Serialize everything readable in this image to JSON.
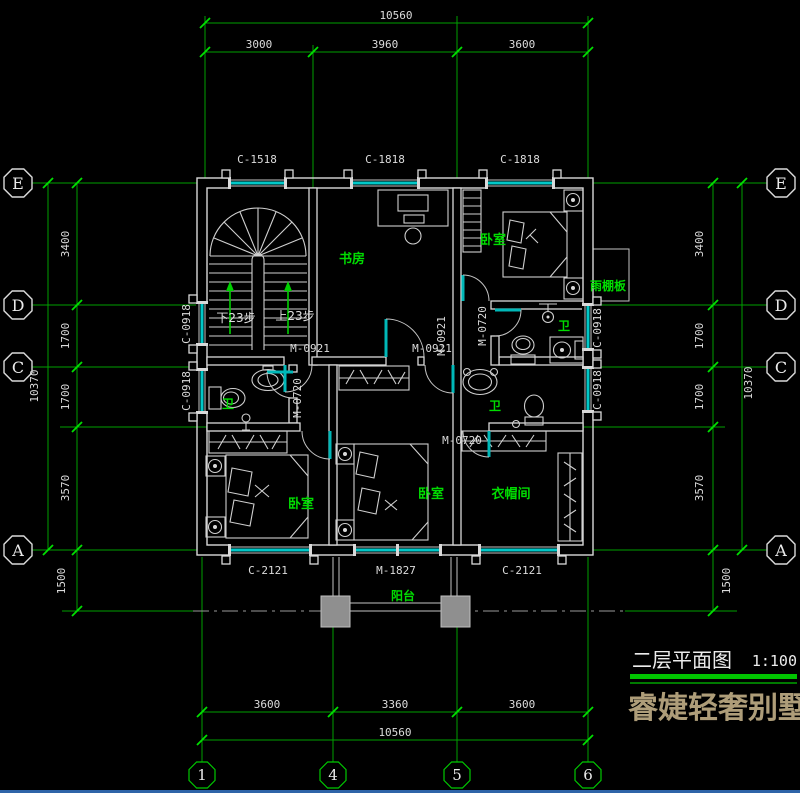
{
  "drawing": {
    "title": "二层平面图",
    "scale": "1:100",
    "brand": "睿婕轻奢别墅"
  },
  "grid": {
    "rows": [
      "E",
      "D",
      "C",
      "A"
    ],
    "cols": [
      "1",
      "4",
      "5",
      "6"
    ]
  },
  "dims": {
    "top": {
      "overall": "10560",
      "seg": [
        "3000",
        "3960",
        "3600"
      ]
    },
    "bottom": {
      "overall": "10560",
      "seg": [
        "3600",
        "3360",
        "3600"
      ]
    },
    "left": {
      "overall": "10370",
      "seg": [
        "3400",
        "1700",
        "1700",
        "3570"
      ],
      "offset": "1500"
    },
    "right": {
      "overall": "10370",
      "seg": [
        "3400",
        "1700",
        "1700",
        "3570"
      ],
      "offset": "1500"
    }
  },
  "windows": {
    "top": [
      "C-1518",
      "C-1818",
      "C-1818"
    ],
    "bottom": [
      "C-2121",
      "M-1827",
      "C-2121"
    ],
    "left": [
      "C-0918",
      "C-0918"
    ],
    "right": [
      "C-0918",
      "C-0918"
    ]
  },
  "doors": {
    "hall_left": "M-0921",
    "hall_right": "M-0921",
    "hall_right_v": "M-0921",
    "bath_left": "M-0720",
    "bath_top_right": "M-0720",
    "closet": "M-0720"
  },
  "rooms": {
    "study": "书房",
    "bedroom_top_right": "卧室",
    "bedroom_bottom_left": "卧室",
    "bedroom_bottom_middle": "卧室",
    "closet": "衣帽间",
    "bath_left": "卫",
    "bath_top_right": "卫",
    "bath_bottom_right": "卫",
    "balcony": "阳台",
    "canopy": "雨棚板"
  },
  "stair": {
    "down": "下23步",
    "up": "上23步"
  },
  "colors": {
    "background": "#000000",
    "axis_green": "#00a000",
    "label_green": "#00dc00",
    "wall_white": "#d9d9d9",
    "window_cyan": "#00c8c8",
    "column_gray": "#8f8f8f",
    "brand_tan": "#ae9d79"
  }
}
